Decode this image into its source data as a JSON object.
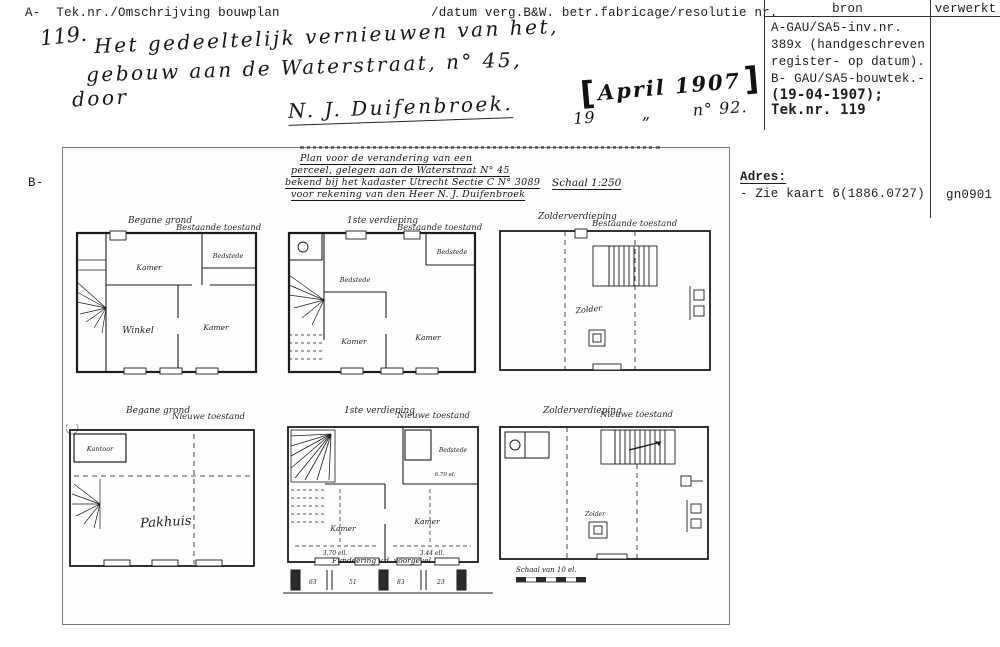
{
  "header": {
    "a_label": "A-",
    "left_title": "Tek.nr./Omschrijving bouwplan",
    "mid_title": "/datum verg.B&W. betr.fabricage/resolutie nr.",
    "table": {
      "col_bron": "bron",
      "col_verwerkt": "verwerkt",
      "bron_lines": [
        "A-GAU/SA5-inv.nr.",
        "389x (handgeschreven",
        "register- op datum).",
        "B- GAU/SA5-bouwtek.-"
      ],
      "bron_bold_lines": [
        "(19-04-1907);",
        "Tek.nr. 119"
      ]
    }
  },
  "handwriting": {
    "number": "119.",
    "line1": "Het gedeeltelijk vernieuwen van het,",
    "line2": "gebouw aan de Waterstraat, n° 45,",
    "door": "door",
    "signature": "N. J. Duifenbroek.",
    "stamp_text": "April 1907",
    "date_left": "19",
    "date_mark": "„",
    "date_right": "n° 92."
  },
  "b_label": "B-",
  "adres": {
    "label": "Adres:",
    "value": "- Zie kaart 6(1886.0727)",
    "code": "gn0901"
  },
  "drawing": {
    "title_line1": "Plan voor de verandering van een",
    "title_line2": "perceel, gelegen aan de Waterstraat N° 45",
    "title_line3": "bekend bij het kadaster Utrecht Sectie C N° 3089",
    "title_line4": "voor rekening van den Heer N. J. Duifenbroek",
    "scale": "Schaal 1:250",
    "plans": [
      {
        "label": "Begane grond",
        "condition": "Bestaande toestand",
        "rooms": [
          "Kamer",
          "Bedstede",
          "Winkel",
          "Kamer"
        ]
      },
      {
        "label": "1ste verdieping",
        "condition": "Bestaande toestand",
        "rooms": [
          "Bedstede",
          "Bedstede",
          "Kamer",
          "Kamer"
        ]
      },
      {
        "label": "Zolderverdieping",
        "condition": "Bestaande toestand",
        "rooms": [
          "Zolder"
        ]
      },
      {
        "label": "Begane grond",
        "condition": "Nieuwe toestand",
        "rooms": [
          "Kantoor",
          "Pakhuis"
        ]
      },
      {
        "label": "1ste verdieping",
        "condition": "Nieuwe toestand",
        "rooms": [
          "Kamer",
          "Kamer",
          "Bedstede"
        ],
        "dims": [
          "3.70 ell.",
          "3.44 ell.",
          "6.70 el."
        ]
      },
      {
        "label": "Zolderverdieping",
        "condition": "Nieuwe toestand",
        "rooms": [
          "Zolder"
        ]
      }
    ],
    "foundation_note": "Fundeering v.d. voorgevel",
    "foundation_numbers": [
      "63",
      "51",
      "83",
      "23"
    ],
    "scalebar_note": "Schaal van 10 el."
  }
}
